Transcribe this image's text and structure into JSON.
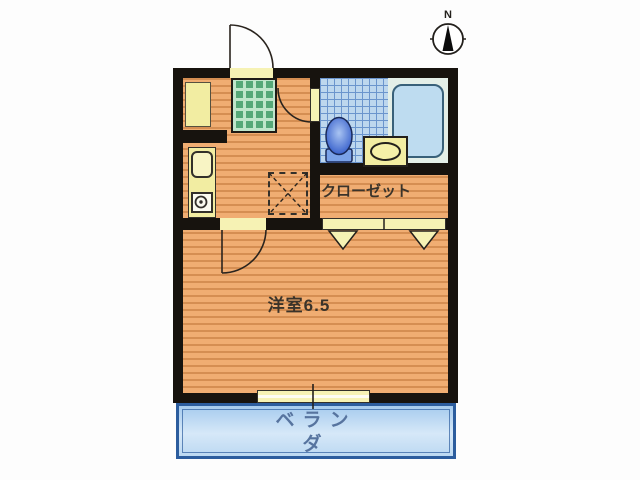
{
  "compass": {
    "label": "N"
  },
  "rooms": {
    "closet": "クローゼット",
    "western_room": "洋室6.5",
    "balcony": "ベランダ"
  },
  "icons": {
    "compass": "compass-icon",
    "toilet": "toilet-icon",
    "bathtub": "bathtub-icon",
    "wash_basin": "wash-basin-icon",
    "kitchen_sink": "kitchen-sink-icon",
    "stove_burner": "stove-burner-icon",
    "refrigerator_space": "refrigerator-space-icon",
    "entrance_mat": "entrance-mat",
    "shoe_cabinet": "shoe-cabinet",
    "entrance_door": "entrance-door-swing",
    "bathroom_door": "bathroom-door-swing",
    "room_door": "room-door-swing",
    "closet_doors": "closet-folding-doors",
    "window": "sliding-window"
  },
  "colors": {
    "wall": "#17130e",
    "floor-base": "#f0ad72",
    "floor-stripe": "#d58e52",
    "mat-base": "#bfe6cb",
    "mat-grid": "#55a878",
    "tile-base": "#bdd7ee",
    "tile-line": "#6b95cd",
    "bath-bg": "#e4efe8",
    "tub-fill": "#bedcf0",
    "tub-edge": "#39617a",
    "fixture-fill": "#f2eda2",
    "door-strip": "#f6f2b4",
    "toilet-dark": "#2d57c8",
    "toilet-light": "#a9c4f2",
    "toilet-tank": "#7aa2e8",
    "balcony-border": "#2c5d9e",
    "balcony-text": "#57749f",
    "label-text": "#3a332a",
    "line": "#2a241e"
  }
}
